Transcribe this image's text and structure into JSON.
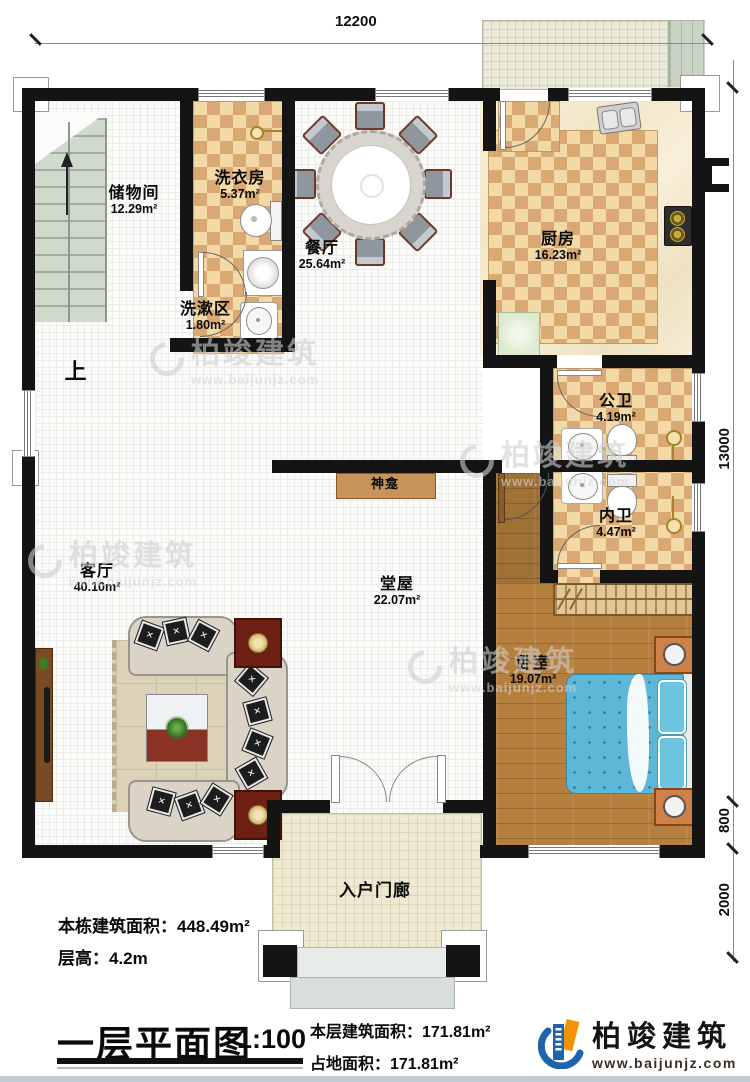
{
  "dimensions": {
    "top": "12200",
    "right_main": "13000",
    "right_mid": "800",
    "right_low": "2000"
  },
  "rooms": {
    "storage": {
      "name": "储物间",
      "area": "12.29m²"
    },
    "laundry": {
      "name": "洗衣房",
      "area": "5.37m²"
    },
    "dining": {
      "name": "餐厅",
      "area": "25.64m²"
    },
    "kitchen": {
      "name": "厨房",
      "area": "16.23m²"
    },
    "washarea": {
      "name": "洗漱区",
      "area": "1.80m²"
    },
    "publicbath": {
      "name": "公卫",
      "area": "4.19m²"
    },
    "innerbath": {
      "name": "内卫",
      "area": "4.47m²"
    },
    "living": {
      "name": "客厅",
      "area": "40.10m²"
    },
    "hall": {
      "name": "堂屋",
      "area": "22.07m²"
    },
    "bedroom": {
      "name": "卧室",
      "area": "19.07m²"
    },
    "porch": {
      "name": "入户门廊"
    },
    "shrine": {
      "name": "神龛"
    },
    "stairs_up": "上"
  },
  "footer": {
    "building_area": "本栋建筑面积：448.49m²",
    "floor_height": "层高：4.2m",
    "title": "一层平面图",
    "scale": "1:100",
    "floor_area": "本层建筑面积：171.81m²",
    "footprint_area": "占地面积：171.81m²"
  },
  "brand": {
    "name": "柏竣建筑",
    "url": "www.baijunjz.com"
  },
  "watermark": {
    "name": "柏竣建筑",
    "url": "www.baijunjz.com"
  },
  "colors": {
    "wall": "#141414",
    "checker_light": "#f2d9a6",
    "checker_dark": "#d9a873",
    "wood": "#b5803e",
    "bed": "#5fb7d7",
    "brand_blue": "#1f63ad",
    "brand_orange": "#f39200"
  }
}
